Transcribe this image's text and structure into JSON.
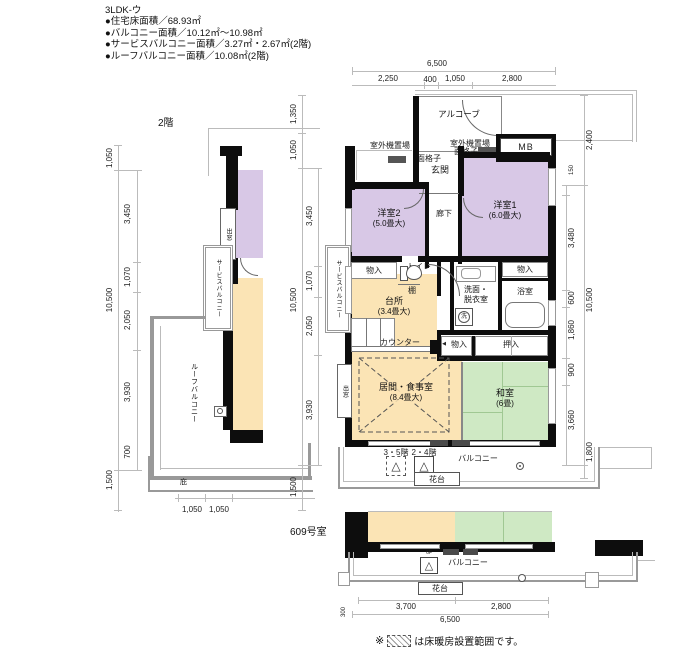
{
  "header": {
    "title": "3LDK-ウ",
    "lines": [
      "●住宅床面積／68.93㎡",
      "●バルコニー面積／10.12㎡〜10.98㎡",
      "●サービスバルコニー面積／3.27㎡・2.67㎡(2階)",
      "●ルーフバルコニー面積／10.08㎡(2階)"
    ]
  },
  "floor2": {
    "title": "2階",
    "bay_window": "出窓",
    "service_balcony": "サービスバルコニー",
    "roof_balcony": "ルーフバルコニー",
    "eaves": "庇",
    "dims": {
      "outer": [
        "1,050",
        "10,500",
        "1,500"
      ],
      "inner": [
        "3,450",
        "1,070",
        "2,050",
        "3,930",
        "700"
      ],
      "bottom": [
        "1,050",
        "1,050"
      ]
    }
  },
  "main": {
    "alcove": "アルコーブ",
    "mb": "MB",
    "outdoor_unit": "室外機置場",
    "lattice": "面格子",
    "entrance": "玄関",
    "corridor": "廊下",
    "western2": "洋室2",
    "western2_size": "(5.0畳大)",
    "western1": "洋室1",
    "western1_size": "(6.0畳大)",
    "storage": "物入",
    "toilet": "トイレ",
    "shelf": "棚",
    "washroom1": "洗面・",
    "washroom2": "脱衣室",
    "wash_mark": "洗",
    "bath": "浴室",
    "kitchen": "台所",
    "kitchen_size": "(3.4畳大)",
    "counter": "カウンター",
    "service_balcony": "サービスバルコニー",
    "living": "居間・食事室",
    "living_size": "(8.4畳大)",
    "japanese": "和室",
    "japanese_size": "(6畳)",
    "oshiire": "押入",
    "bay_window": "出窓",
    "balcony": "バルコニー",
    "flower_stand": "花台",
    "hatch35": "3・5階",
    "hatch24": "2・4階",
    "hatch_glyph": "△",
    "arrow": "◀",
    "dims": {
      "top_total": "6,500",
      "top": [
        "2,250",
        "400",
        "1,050",
        "2,800"
      ],
      "left_outer": [
        "1,350",
        "1,050",
        "10,500",
        "1,500"
      ],
      "left_inner": [
        "3,450",
        "1,070",
        "2,050",
        "3,930"
      ],
      "right_outer": [
        "2,400",
        "10,500",
        "1,800"
      ],
      "right_inner": [
        "150",
        "3,480",
        "600",
        "1,860",
        "900",
        "3,660"
      ]
    }
  },
  "room609": {
    "title": "609号室",
    "balcony": "バルコニー",
    "flower_stand": "花台",
    "floor6": "6F",
    "dims": {
      "bottom": [
        "3,700",
        "2,800"
      ],
      "total": "6,500",
      "offset": "300"
    }
  },
  "footer": {
    "prefix": "※",
    "suffix": "は床暖房設置範囲です。"
  },
  "colors": {
    "western": "#d8c8e6",
    "wood": "#fbe4b5",
    "tatami": "#cfe9c4",
    "wall": "#0d0d0d"
  }
}
